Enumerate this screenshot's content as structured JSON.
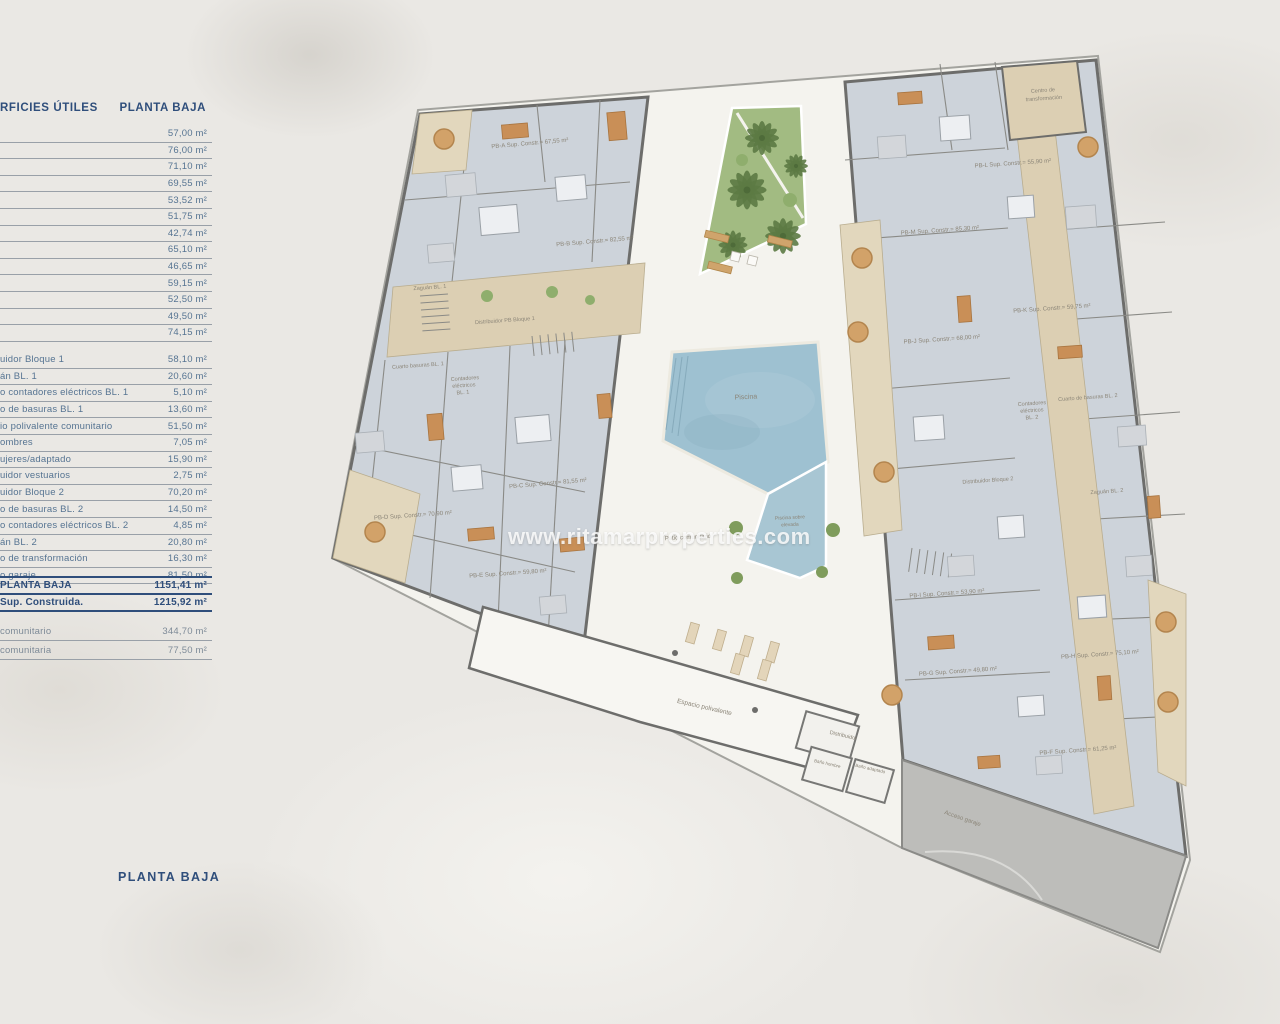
{
  "page": {
    "watermark": "www.ritamarproperties.com",
    "footer_label": "PLANTA BAJA"
  },
  "colors": {
    "navy": "#2f4e7b",
    "slate_row": "#567492",
    "plan_wall": "#6d6d6b",
    "apartment_fill": "#cdd3da",
    "terrace_beige": "#dccfb3",
    "garden_green": "#a2bb82",
    "pool_blue": "#9ec1d1",
    "garage_gray": "#bdbdba"
  },
  "table": {
    "header": {
      "left": "RFICIES ÚTILES",
      "right": "PLANTA BAJA"
    },
    "section_a": [
      {
        "label": "",
        "value": "57,00 m²"
      },
      {
        "label": "",
        "value": "76,00 m²"
      },
      {
        "label": "",
        "value": "71,10 m²"
      },
      {
        "label": "",
        "value": "69,55 m²"
      },
      {
        "label": "",
        "value": "53,52 m²"
      },
      {
        "label": "",
        "value": "51,75 m²"
      },
      {
        "label": "",
        "value": "42,74 m²"
      },
      {
        "label": "",
        "value": "65,10 m²"
      },
      {
        "label": "",
        "value": "46,65 m²"
      },
      {
        "label": "",
        "value": "59,15 m²"
      },
      {
        "label": "",
        "value": "52,50 m²"
      },
      {
        "label": "",
        "value": "49,50 m²"
      },
      {
        "label": "",
        "value": "74,15 m²"
      }
    ],
    "section_b": [
      {
        "label": "uidor Bloque 1",
        "value": "58,10 m²"
      },
      {
        "label": "án BL. 1",
        "value": "20,60 m²"
      },
      {
        "label": "o contadores eléctricos BL. 1",
        "value": "5,10 m²"
      },
      {
        "label": "o de basuras BL. 1",
        "value": "13,60 m²"
      },
      {
        "label": "io polivalente comunitario",
        "value": "51,50 m²"
      },
      {
        "label": "ombres",
        "value": "7,05 m²"
      },
      {
        "label": "ujeres/adaptado",
        "value": "15,90 m²"
      },
      {
        "label": "uidor vestuarios",
        "value": "2,75 m²"
      },
      {
        "label": "uidor Bloque 2",
        "value": "70,20 m²"
      },
      {
        "label": "o de basuras BL. 2",
        "value": "14,50 m²"
      },
      {
        "label": "o contadores eléctricos BL. 2",
        "value": "4,85 m²"
      },
      {
        "label": "án BL. 2",
        "value": "20,80 m²"
      },
      {
        "label": "o de transformación",
        "value": "16,30 m²"
      },
      {
        "label": "o garaje",
        "value": "81,50 m²"
      }
    ],
    "totals": [
      {
        "label": "PLANTA BAJA",
        "value": "1151,41 m²"
      },
      {
        "label": "Sup. Construida.",
        "value": "1215,92 m²"
      }
    ],
    "extras": [
      {
        "label": "comunitario",
        "value": "344,70 m²"
      },
      {
        "label": "comunitaria",
        "value": "77,50 m²"
      }
    ]
  },
  "plan": {
    "apartments": {
      "a": "PB-A Sup. Constr.= 67,55 m²",
      "b": "PB-B Sup. Constr.= 82,55 m²",
      "c": "PB-C Sup. Constr.= 81,55 m²",
      "d": "PB-D Sup. Constr.= 70,90 m²",
      "e": "PB-E Sup. Constr.= 59,80 m²",
      "f": "PB-F Sup. Constr.= 61,25 m²",
      "g": "PB-G Sup. Constr.= 49,80 m²",
      "h": "PB-H Sup. Constr.= 75,10 m²",
      "i": "PB-I Sup. Constr.= 53,90 m²",
      "j": "PB-J Sup. Constr.= 68,00 m²",
      "k": "PB-K Sup. Constr.= 59,75 m²",
      "l": "PB-L Sup. Constr.= 55,90 m²",
      "m": "PB-M Sup. Constr.= 85,30 m²"
    },
    "rooms": {
      "zaguan_bl1": "Zaguán BL. 1",
      "distribuidor_pb_bloque1": "Distribuidor PB Bloque 1",
      "cuarto_basuras_bl1": "Cuarto basuras BL. 1",
      "contadores_bl1": [
        "Contadores",
        "eléctricos",
        "BL. 1"
      ],
      "centro_transformacion": [
        "Centro de",
        "transformación"
      ],
      "cuarto_basuras_bl2": "Cuarto de basuras BL. 2",
      "contadores_bl2": [
        "Contadores",
        "eléctricos",
        "BL. 2"
      ],
      "distribuidor_bloque2": "Distribuidor Bloque 2",
      "zaguan_bl2": "Zaguán BL. 2",
      "piscina": "Piscina",
      "piscina_elevada": [
        "Piscina sobre",
        "elevada"
      ],
      "patio": "Patio comunitario",
      "espacio": "Espacio polivalente",
      "distribuidor": "Distribuidor",
      "bano_hombre": "Baño hombre",
      "bano_adaptado": "Baño adaptado",
      "acceso_garaje": "Acceso garaje"
    }
  }
}
